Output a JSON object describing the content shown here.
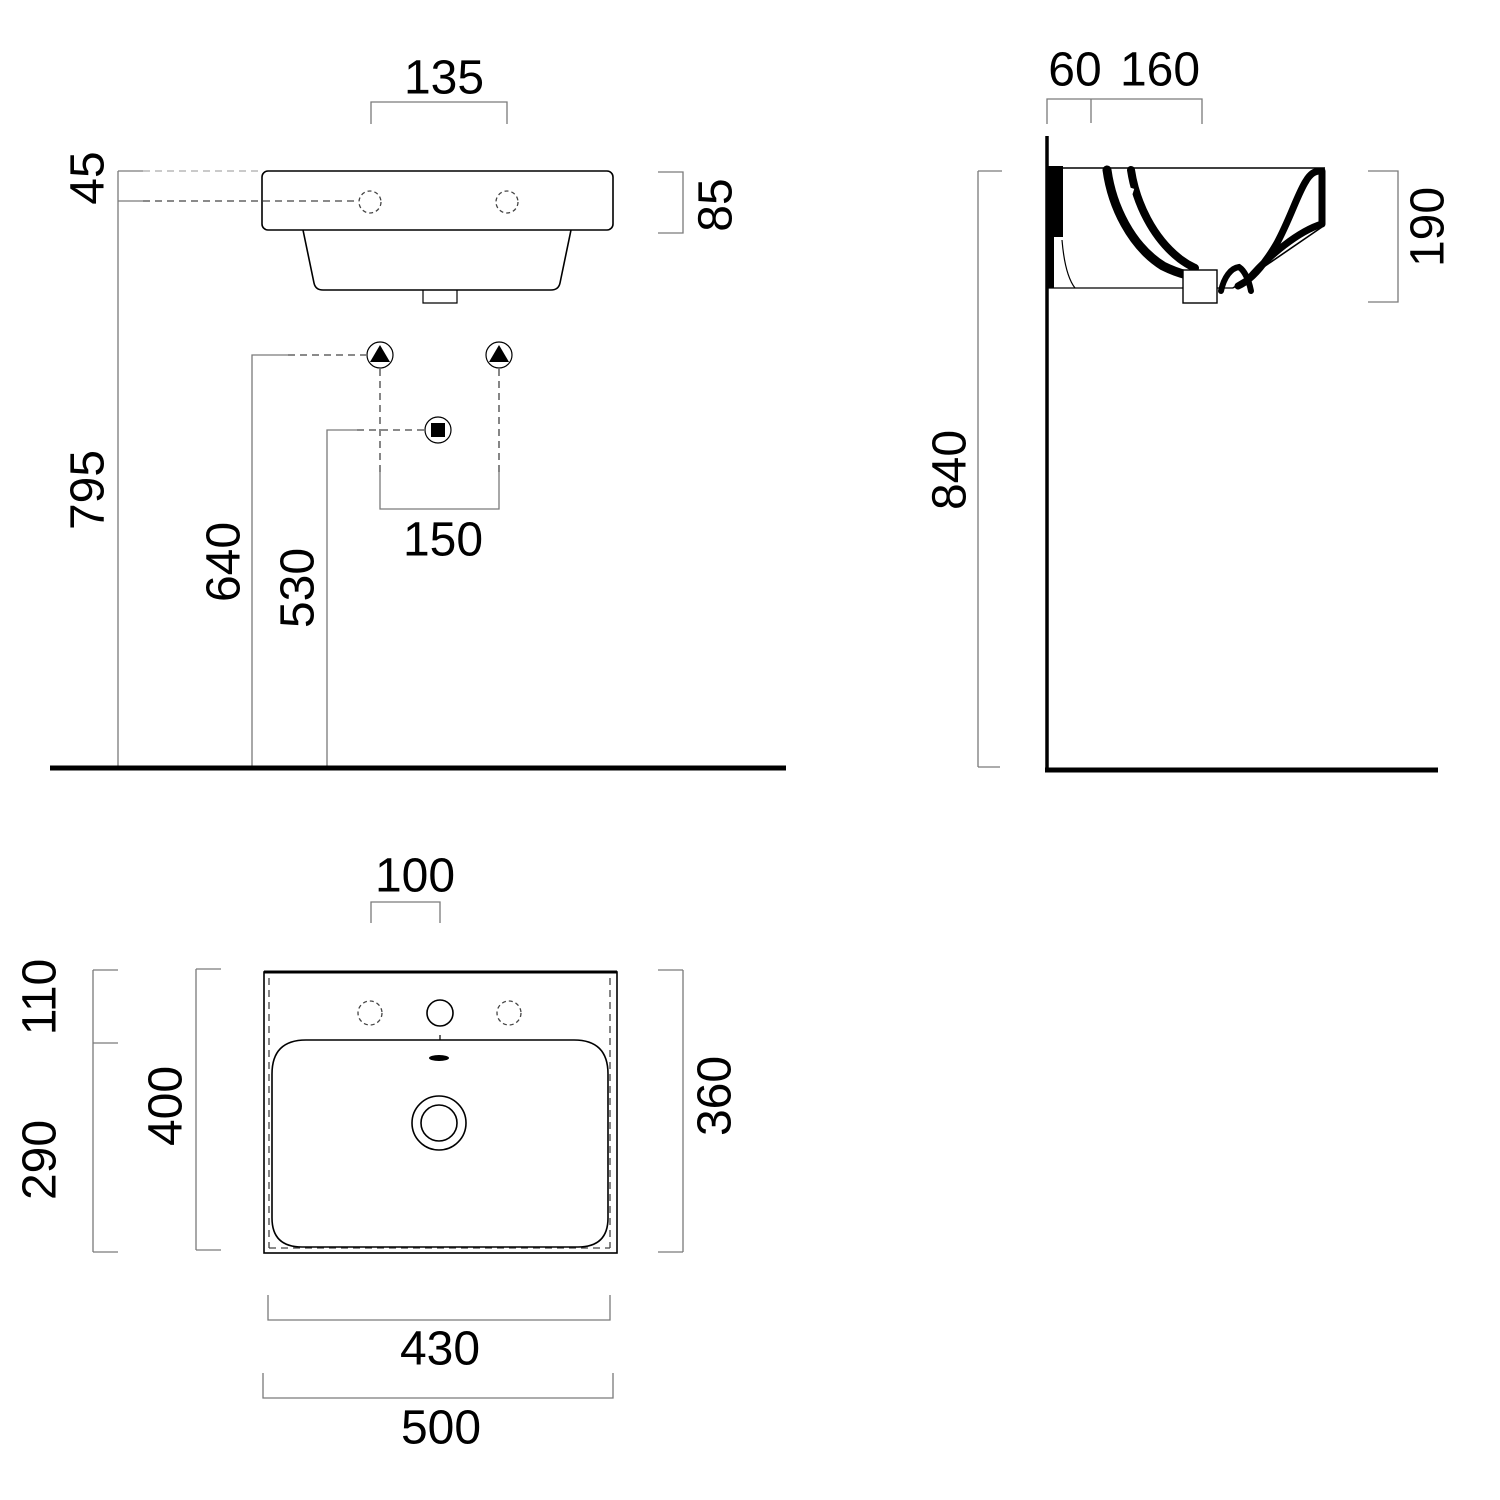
{
  "dims": {
    "front": {
      "tap_hole_spacing": "135",
      "rim_to_tap_axis": "45",
      "rim_height": "85",
      "tap_axis_height": "795",
      "fixing_height": "640",
      "drain_height": "530",
      "fixing_spacing": "150"
    },
    "side": {
      "wall_offset": "60",
      "tap_zone_depth": "160",
      "basin_section_height": "190",
      "rim_height_from_floor": "840"
    },
    "plan": {
      "tap_hole_offset": "100",
      "rear_zone_depth": "110",
      "bowl_front_depth": "290",
      "total_depth": "400",
      "bowl_inner_depth": "360",
      "body_width": "430",
      "total_width": "500"
    }
  },
  "symbols": {
    "fixing_point": "filled triangle in circle",
    "drain_point": "filled square in circle"
  },
  "colors": {
    "outline": "#000000",
    "dimension_line": "#7a7a7a",
    "dashed_reference": "#444444",
    "light_dashed": "#aaaaaa",
    "background": "#ffffff"
  }
}
